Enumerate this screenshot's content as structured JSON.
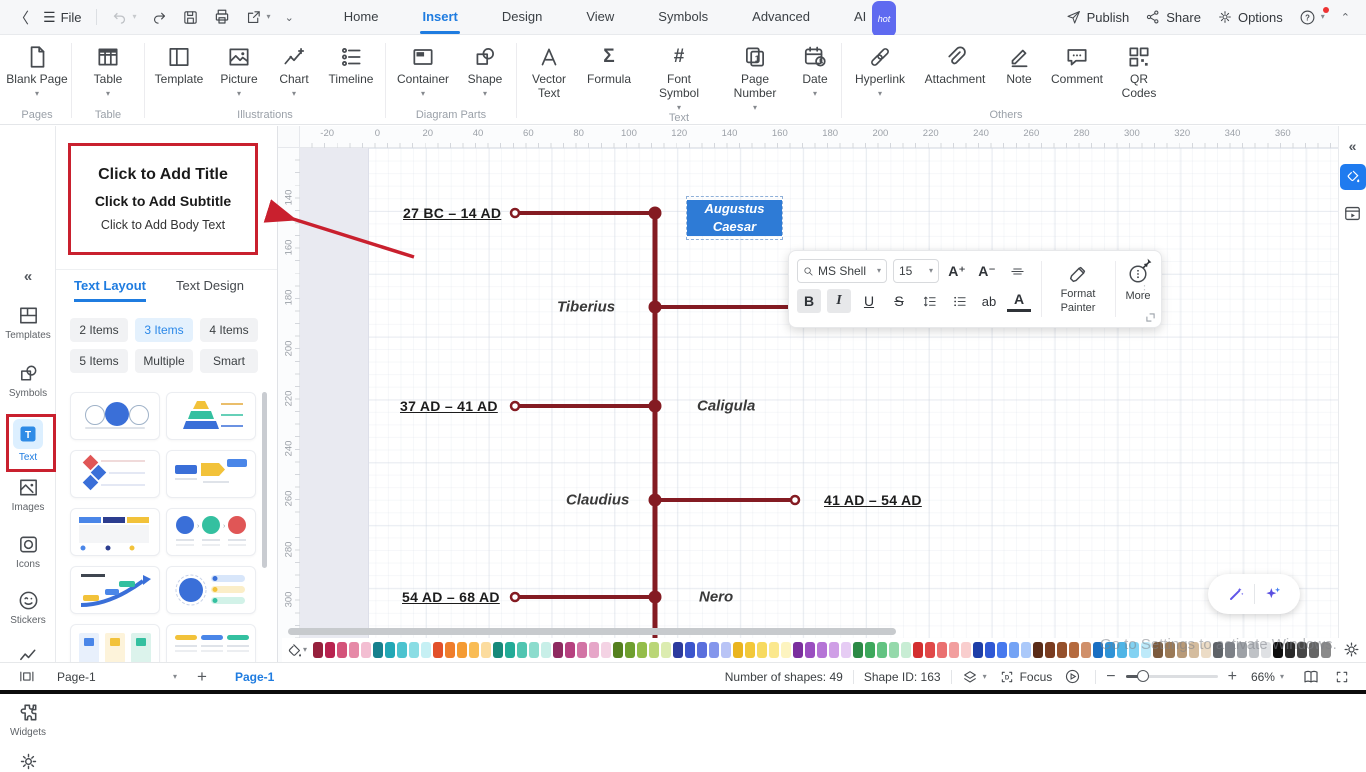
{
  "titlebar": {
    "file": "File",
    "tabs": [
      "Home",
      "Insert",
      "Design",
      "View",
      "Symbols",
      "Advanced",
      "AI"
    ],
    "active_tab": "Insert",
    "ai_badge": "hot",
    "publish": "Publish",
    "share": "Share",
    "options": "Options"
  },
  "ribbon": {
    "groups": [
      {
        "label": "Pages",
        "items": [
          {
            "label": "Blank Page"
          }
        ]
      },
      {
        "label": "Table",
        "items": [
          {
            "label": "Table"
          }
        ]
      },
      {
        "label": "Illustrations",
        "items": [
          {
            "label": "Template"
          },
          {
            "label": "Picture"
          },
          {
            "label": "Chart"
          },
          {
            "label": "Timeline"
          }
        ]
      },
      {
        "label": "Diagram Parts",
        "items": [
          {
            "label": "Container"
          },
          {
            "label": "Shape"
          }
        ]
      },
      {
        "label": "Text",
        "items": [
          {
            "label": "Vector Text"
          },
          {
            "label": "Formula"
          },
          {
            "label": "Font Symbol"
          },
          {
            "label": "Page Number"
          },
          {
            "label": "Date"
          }
        ]
      },
      {
        "label": "Others",
        "items": [
          {
            "label": "Hyperlink"
          },
          {
            "label": "Attachment"
          },
          {
            "label": "Note"
          },
          {
            "label": "Comment"
          },
          {
            "label": "QR Codes"
          }
        ]
      }
    ]
  },
  "left_rail": {
    "items": [
      "Templates",
      "Symbols",
      "Text",
      "Images",
      "Icons",
      "Stickers",
      "Charts",
      "Widgets"
    ],
    "active_item": "Text"
  },
  "panel": {
    "placeholder": {
      "title": "Click to Add Title",
      "subtitle": "Click to Add Subtitle",
      "body": "Click to Add Body Text"
    },
    "tabs": [
      "Text Layout",
      "Text Design"
    ],
    "active_tab": "Text Layout",
    "item_buttons": [
      "2 Items",
      "3 Items",
      "4 Items",
      "5 Items",
      "Multiple",
      "Smart"
    ],
    "active_item_button": "3 Items"
  },
  "canvas": {
    "ruler_h": [
      "-20",
      "0",
      "20",
      "40",
      "60",
      "80",
      "100",
      "120",
      "140",
      "160",
      "180",
      "200",
      "220",
      "240",
      "260",
      "280",
      "300",
      "320",
      "340",
      "360"
    ],
    "ruler_v": [
      "140",
      "160",
      "180",
      "200",
      "220",
      "240",
      "260",
      "280",
      "300"
    ],
    "timeline": {
      "line_color": "#841b22",
      "entries": {
        "date1": "27 BC – 14 AD",
        "name1": "Augustus Caesar",
        "name2": "Tiberius",
        "date2": "37 AD – 41 AD",
        "name3": "Caligula",
        "name4": "Claudius",
        "date3": "41 AD – 54 AD",
        "date4": "54 AD – 68 AD",
        "name5": "Nero"
      },
      "selected_entry": "Augustus Caesar"
    }
  },
  "floating_toolbar": {
    "font_family": "MS Shell",
    "font_size": "15",
    "increase": "A⁺",
    "decrease": "A⁻",
    "bold": "B",
    "italic": "I",
    "underline": "U",
    "strike": "S",
    "highlight": "ab",
    "font_color": "A",
    "format_painter": "Format Painter",
    "more": "More"
  },
  "colorbar": {
    "swatches": [
      "#96203c",
      "#b8234f",
      "#d4537a",
      "#e689a7",
      "#f3bed2",
      "#17808d",
      "#22a7b5",
      "#4cc3cf",
      "#8adde4",
      "#c6f0f4",
      "#e2502a",
      "#ef7d2c",
      "#f59b33",
      "#f9bc55",
      "#fcdc9e",
      "#17897a",
      "#23ab97",
      "#50c5b1",
      "#8cdccd",
      "#c8efe8",
      "#8f2a60",
      "#b6407f",
      "#d274a5",
      "#e6a6c8",
      "#f4d3e4",
      "#55801f",
      "#6f9f2f",
      "#94bd4a",
      "#bad677",
      "#dcecb0",
      "#2c3b9e",
      "#3c55cc",
      "#5a6fdd",
      "#8496ec",
      "#b9c4f6",
      "#eab41f",
      "#f2c83a",
      "#f7da60",
      "#fbe88e",
      "#fdf4c0",
      "#7b2f9e",
      "#9a4ec0",
      "#b574d6",
      "#cf9fe6",
      "#e6ccf4",
      "#2c8a46",
      "#3da85c",
      "#63c382",
      "#95d9ab",
      "#c8edd4",
      "#d32f2f",
      "#e04848",
      "#ea7070",
      "#f29e9e",
      "#f9cece",
      "#1e3ea8",
      "#2f58d4",
      "#4679ee",
      "#74a3f5",
      "#abc9fa",
      "#5a2c18",
      "#7a3c20",
      "#95502b",
      "#b56a3e",
      "#d0906a",
      "#1b6fc2",
      "#2f93d6",
      "#4fb5e6",
      "#83d2f2",
      "#bdeafa",
      "#7c5b3e",
      "#9b7a57",
      "#b89a78",
      "#d4bc9e",
      "#ecdcc6",
      "#5f6368",
      "#7d8187",
      "#9da1a6",
      "#bfc2c6",
      "#dfe1e4",
      "#0e0e0e",
      "#2a2a2a",
      "#474747",
      "#666666",
      "#8a8a8a"
    ]
  },
  "statusbar": {
    "page_selector": "Page-1",
    "page_tab": "Page-1",
    "shapes": "Number of shapes: 49",
    "shape_id": "Shape ID: 163",
    "focus": "Focus",
    "zoom": "66%"
  },
  "watermark": "Go to Settings to activate Windows."
}
